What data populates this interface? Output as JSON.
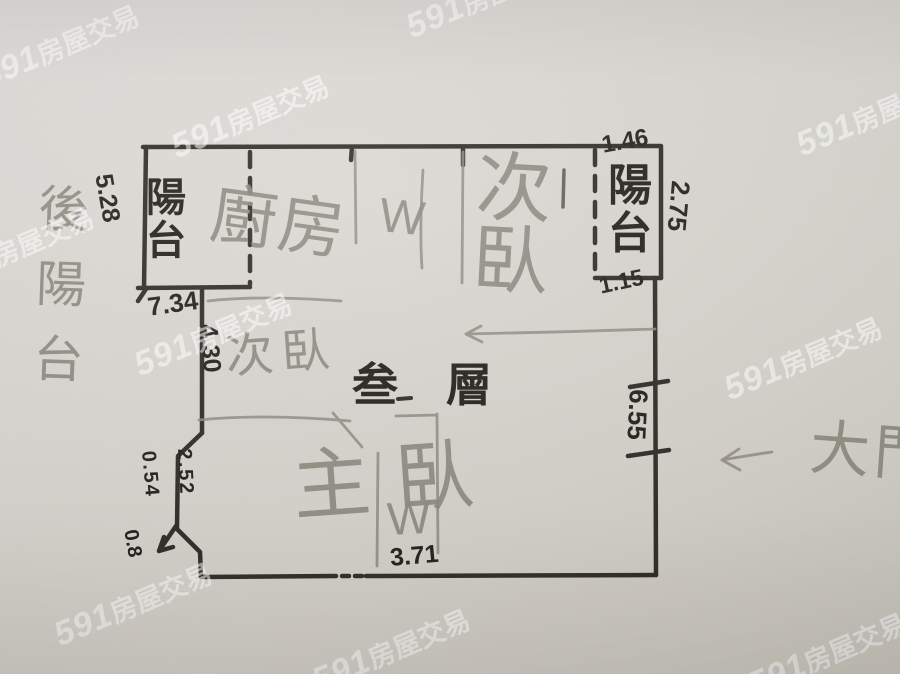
{
  "watermark": {
    "brand": "591",
    "suffix": "房屋交易"
  },
  "labels": {
    "balcony_left": "陽台",
    "balcony_right": "陽台",
    "back_balcony": "後陽台",
    "kitchen": "廚房",
    "bedroom_top": "次臥",
    "bedroom_mid": "次臥",
    "master_bedroom": "主臥",
    "main_door": "大門",
    "floor": "叁層",
    "wc_top": "W",
    "wc_bottom": "W"
  },
  "dimensions": {
    "balcony_left_side": "5.28",
    "balcony_left_bottom": "7.34",
    "left_wall": "4.30",
    "balcony_right_top": "1.46",
    "balcony_right_side": "2.75",
    "balcony_right_bottom": "1.15",
    "right_wall": "6.55",
    "notch_upper": "0.54",
    "notch_lower": "2.52",
    "notch_corner": "0.8",
    "bottom_wc": "3.71"
  },
  "colors": {
    "marker": "#26251f",
    "pencil": "#8e8b80",
    "paper": "#d8d5ce",
    "watermark": "#ffffff"
  }
}
